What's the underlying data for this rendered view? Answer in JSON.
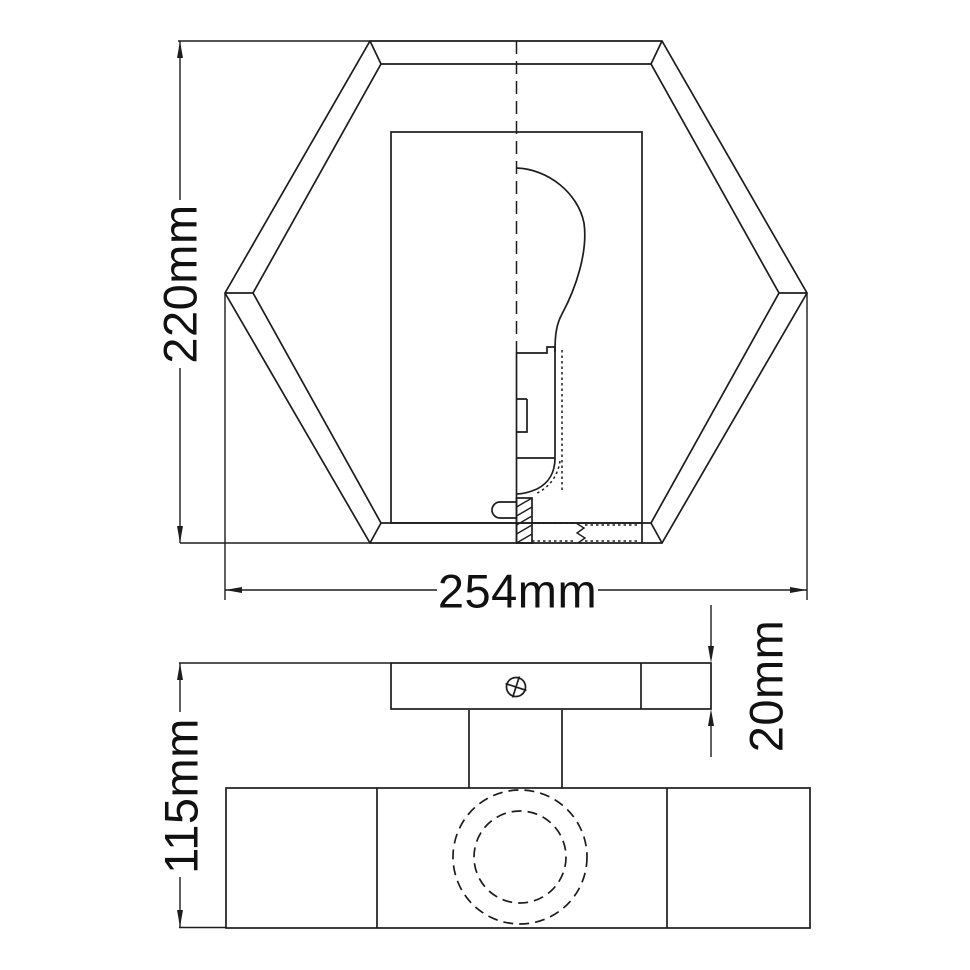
{
  "drawing": {
    "type": "technical-dimension-drawing",
    "background_color": "#ffffff",
    "line_color": "#1d1d1d",
    "views": {
      "front_view": {
        "shape": "hexagonal-shade-with-bulb",
        "height_label": "220mm",
        "width_label": "254mm"
      },
      "side_view": {
        "shape": "mounting-plate-and-body",
        "plate_thickness_label": "20mm",
        "body_height_label": "115mm"
      }
    },
    "icons": {
      "screw_head": "circle-with-cross"
    }
  }
}
